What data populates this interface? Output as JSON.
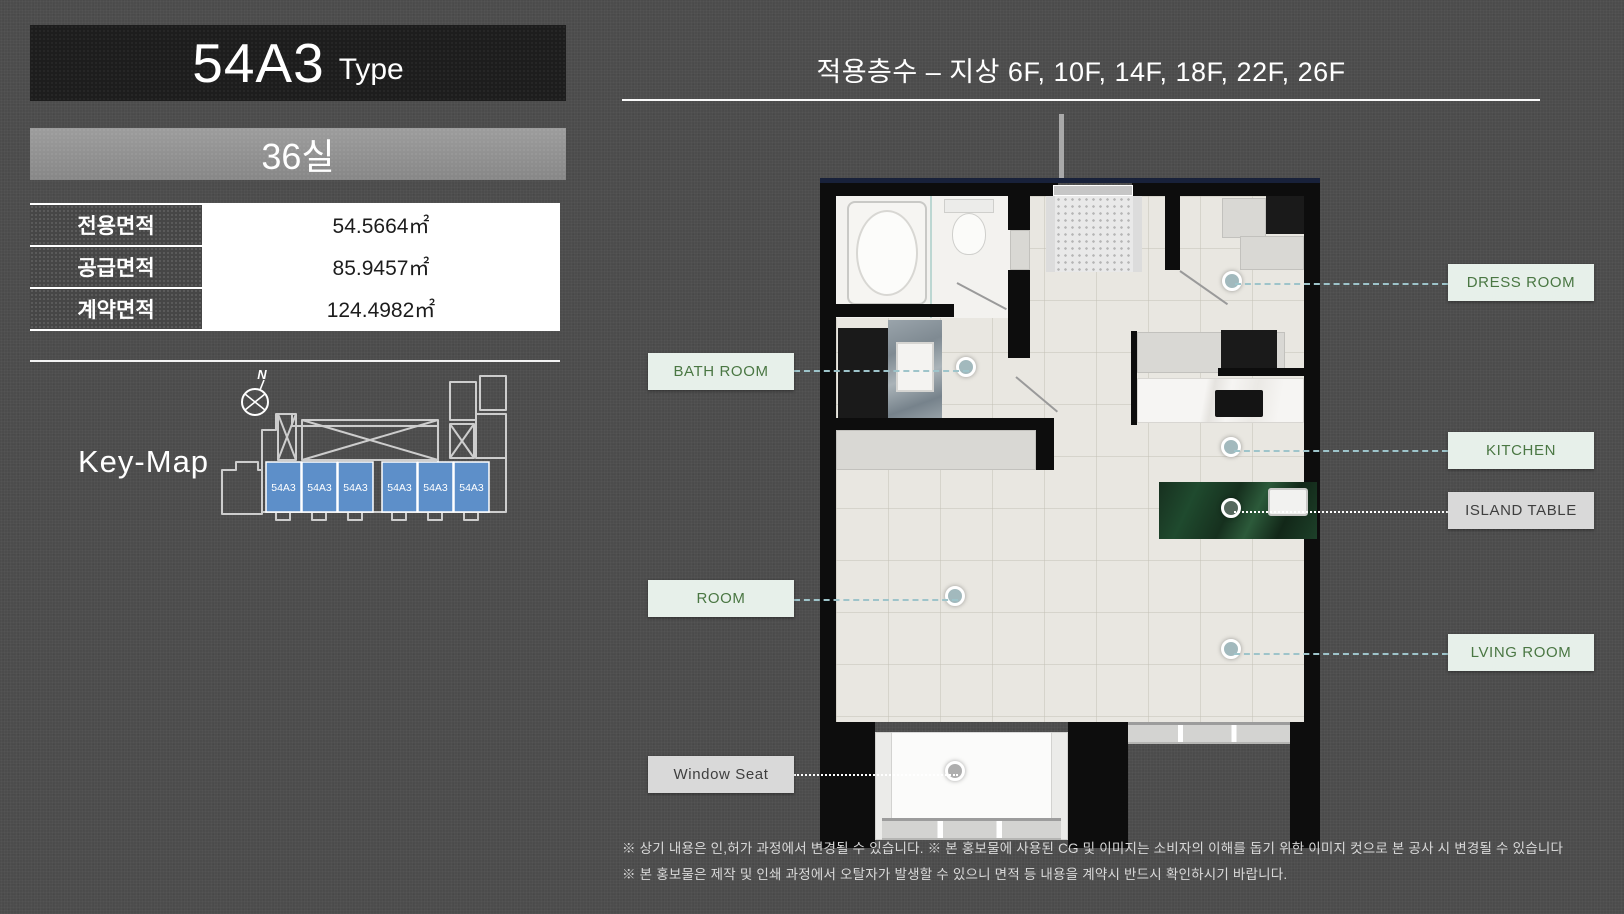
{
  "header": {
    "type_title": "54A3",
    "type_suffix": "Type",
    "unit_count": "36실",
    "floors_title": "적용층수 – 지상 6F, 10F, 14F, 18F, 22F, 26F"
  },
  "area_table": {
    "rows": [
      {
        "label": "전용면적",
        "value": "54.5664㎡"
      },
      {
        "label": "공급면적",
        "value": "85.9457㎡"
      },
      {
        "label": "계약면적",
        "value": "124.4982㎡"
      }
    ]
  },
  "key_map": {
    "title": "Key-Map",
    "compass_label": "N",
    "unit_labels": [
      "54A3",
      "54A3",
      "54A3",
      "54A3",
      "54A3",
      "54A3"
    ],
    "unit_color": "#5d8fc9"
  },
  "floor_plan": {
    "labels": [
      {
        "id": "dress-room",
        "text": "DRESS ROOM",
        "style": "mint",
        "side": "right"
      },
      {
        "id": "bath-room",
        "text": "BATH ROOM",
        "style": "mint",
        "side": "left"
      },
      {
        "id": "kitchen",
        "text": "KITCHEN",
        "style": "mint",
        "side": "right"
      },
      {
        "id": "island-table",
        "text": "ISLAND TABLE",
        "style": "gray",
        "side": "right"
      },
      {
        "id": "room",
        "text": "ROOM",
        "style": "mint",
        "side": "left"
      },
      {
        "id": "living-room",
        "text": "LVING ROOM",
        "style": "mint",
        "side": "right"
      },
      {
        "id": "window-seat",
        "text": "Window Seat",
        "style": "gray",
        "side": "left"
      }
    ]
  },
  "footnotes": [
    "※ 상기 내용은 인,허가 과정에서 변경될 수 있습니다. ※ 본 홍보물에 사용된 CG 및 이미지는 소비자의 이해를 돕기 위한 이미지 컷으로 본 공사 시 변경될 수 있습니다",
    "※ 본 홍보물은 제작 및 인쇄 과정에서 오탈자가 발생할 수 있으니 면적 등 내용을 계약시 반드시 확인하시기 바랍니다."
  ],
  "colors": {
    "background": "#4c4c4c",
    "title_box": "#1d1d1d",
    "label_mint_bg": "#e7f0ea",
    "label_green_text": "#4a7743",
    "label_gray_bg": "#d9d9d9",
    "keymap_unit_blue": "#5d8fc9",
    "island_marble_green": "#1f4a2e",
    "leader_dash_teal": "#9ec4ca",
    "wall_black": "#0d0d0d",
    "floor_cream": "#e9e7e1"
  }
}
